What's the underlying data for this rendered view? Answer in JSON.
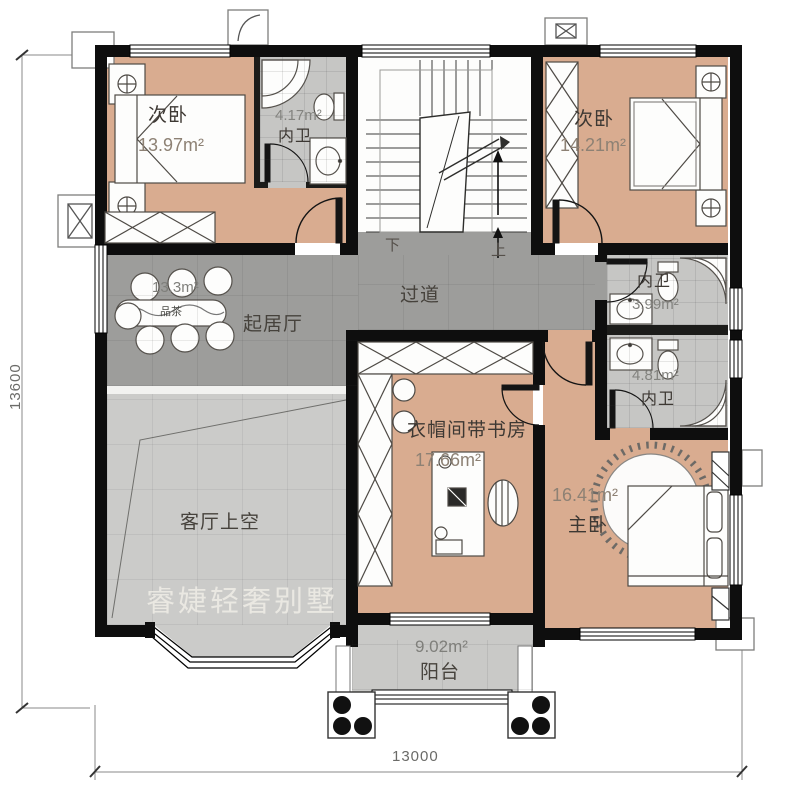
{
  "floorplan": {
    "watermark": "睿婕轻奢别墅",
    "dimensions": {
      "total_height_mm": "13600",
      "total_width_mm": "13000"
    },
    "rooms": {
      "bedroom_left": {
        "name": "次卧",
        "area": "13.97m²"
      },
      "bath_top": {
        "name": "内卫",
        "area": "4.17m²"
      },
      "bedroom_right": {
        "name": "次卧",
        "area": "14.21m²"
      },
      "corridor": {
        "name": "过道"
      },
      "living": {
        "name": "起居厅",
        "area": "13.3m²"
      },
      "tea_table": {
        "label": "品茶"
      },
      "bath_right_upper": {
        "name": "内卫",
        "area": "3.99m²"
      },
      "bath_right_lower": {
        "name": "内卫",
        "area": "4.81m²"
      },
      "study": {
        "name": "衣帽间带书房",
        "area": "17.66m²"
      },
      "master": {
        "name": "主卧",
        "area": "16.41m²"
      },
      "living_void": {
        "name": "客厅上空"
      },
      "balcony": {
        "name": "阳台",
        "area": "9.02m²"
      }
    },
    "stairs": {
      "down": "下",
      "up": "上"
    },
    "colors": {
      "room_fill": "#d9ac90",
      "floor_gray": "#9d9d9b",
      "tile_gray": "#c6c6c4",
      "void_gray": "#cbcbc9",
      "wall": "#0e0e0e"
    }
  }
}
